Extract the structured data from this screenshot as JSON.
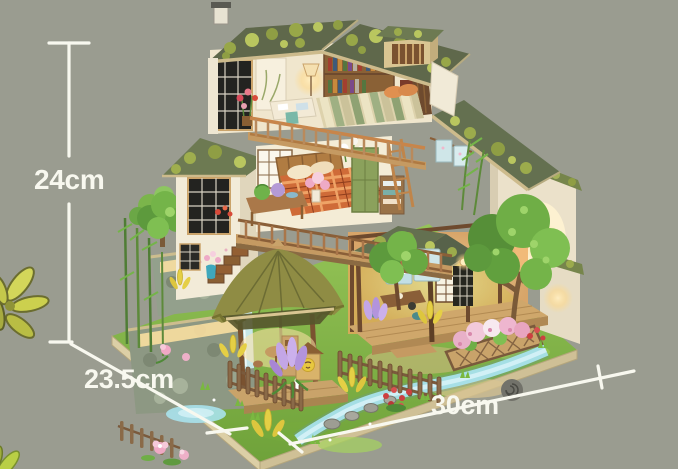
{
  "image": {
    "type": "product-photo",
    "subject": "DIY miniature dollhouse kit — three-story Japanese-style wooden house with moss-covered roofs, attic and plaid-bed bedrooms, thatched garden gazebo, stone waterfall terraces, flower garden, stream and warm interior lighting, photographed on a grey-green backdrop with printed size arrows",
    "background_color": "#9a9c90"
  },
  "dimensions": {
    "height_label": "24cm",
    "depth_label": "23.5cm",
    "width_label": "30cm",
    "line_color": "#f8f8ef",
    "label_color": "#f8f8ef"
  },
  "palette": {
    "roof_slate": "#5f684b",
    "roof_moss": "#9cab4c",
    "roof_trim": "#cdbb8c",
    "thatch": "#8f8c44",
    "wood_light": "#c59a62",
    "wood_mid": "#a9764a",
    "wood_dark": "#6e4a2e",
    "wall_cream": "#f0e8d4",
    "stone": "#8d9883",
    "grass": "#86ba4b",
    "stream": "#a8e2ec",
    "warm_light": "#ffd98a",
    "flower_pink": "#efa9c4",
    "flower_purple": "#c3a6e6",
    "flower_red": "#cc4040",
    "flower_yellow": "#e5cf45",
    "leaf_decoration": "#ccd04e"
  }
}
